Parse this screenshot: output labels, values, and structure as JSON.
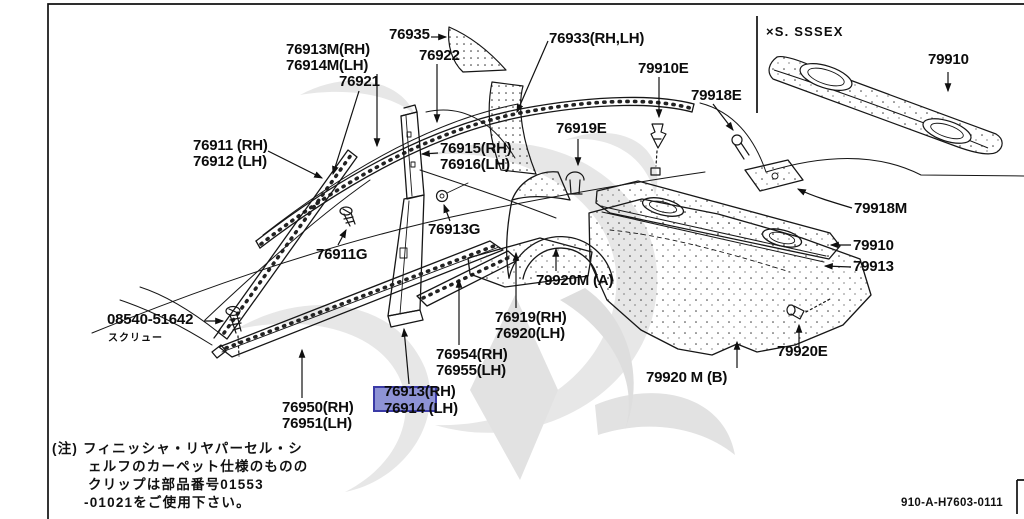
{
  "diagram": {
    "colors": {
      "background": "#ffffff",
      "line": "#151515",
      "watermark": "#e7e7e7",
      "highlight_fill": "#8e93d5",
      "highlight_border": "#3a3aa6"
    },
    "ref_code": "910-A-H7603-0111",
    "inset": {
      "variant": "×S. SSSEX",
      "part_number": "79910"
    },
    "highlight": {
      "selected_part": "76913",
      "selected_suffix": "(RH)",
      "pair_line": "76914 (LH)"
    },
    "screw": {
      "part_number": "08540-51642",
      "caption": "スクリュー"
    },
    "note": {
      "lines": [
        "(注) フィニッシャ・リヤパーセル・シ",
        "ェルフのカーペット仕様のものの",
        "クリップは部品番号01553",
        "-01021をご使用下さい。"
      ]
    },
    "labels": {
      "l76935": "76935",
      "l76922": "76922",
      "l76933": "76933(RH,LH)",
      "l76913m": [
        "76913M(RH)",
        "76914M(LH)"
      ],
      "l76921": "76921",
      "l76911": [
        "76911 (RH)",
        "76912 (LH)"
      ],
      "l76915": [
        "76915(RH)",
        "76916(LH)"
      ],
      "l76919e": "76919E",
      "l79910e": "79910E",
      "l79918e": "79918E",
      "l76913g": "76913G",
      "l76911g": "76911G",
      "l79918m": "79918M",
      "l79910": "79910",
      "l79913": "79913",
      "l79920e": "79920E",
      "l79920ma": "79920M (A)",
      "l76919": [
        "76919(RH)",
        "76920(LH)"
      ],
      "l76954": [
        "76954(RH)",
        "76955(LH)"
      ],
      "l79920mb": "79920 M (B)",
      "l76950": [
        "76950(RH)",
        "76951(LH)"
      ]
    }
  }
}
